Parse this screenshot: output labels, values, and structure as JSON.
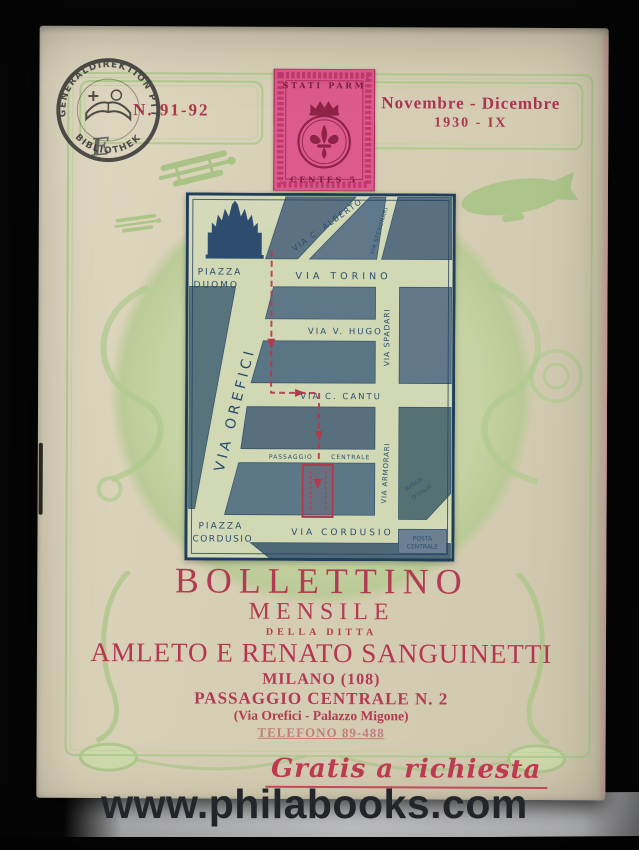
{
  "photo": {
    "watermark_text": "www.philabooks.com"
  },
  "cover": {
    "issue_number": "N. 91-92",
    "date_line1": "Novembre - Dicembre",
    "date_line2": "1930 - IX",
    "handwritten_mark": "E",
    "library_stamp": {
      "arc_top": "GENERALDIREKTION PTT",
      "arc_bottom": "BIBLIOTHEK"
    },
    "postage_stamp": {
      "top_label": "STATI PARM",
      "bottom_label": "CENTES 5"
    }
  },
  "map": {
    "streets": {
      "piazza_duomo_1": "PIAZZA",
      "piazza_duomo_2": "DUOMO",
      "via_c_alberto": "VIA C. ALBERTO",
      "via_speronari": "VIA SPERONARI",
      "via_torino": "VIA TORINO",
      "via_v_hugo": "VIA V. HUGO",
      "via_spadari": "VIA SPADARI",
      "via_c_cantu": "VIA C. CANTU",
      "via_orefici": "VIA OREFICI",
      "passaggio_1": "PASSAGGIO",
      "passaggio_2": "CENTRALE",
      "via_armorari": "VIA ARMORARI",
      "piazza_cordusio_1": "PIAZZA",
      "piazza_cordusio_2": "CORDUSIO",
      "via_cordusio": "VIA CORDUSIO",
      "banca_1": "BANCA",
      "banca_2": "D'ITALIA",
      "posta_1": "POSTA",
      "posta_2": "CENTRALE"
    }
  },
  "title_block": {
    "line1": "BOLLETTINO",
    "line2": "MENSILE",
    "line3": "DELLA DITTA",
    "company": "AMLETO E RENATO SANGUINETTI",
    "city": "MILANO (108)",
    "address": "PASSAGGIO CENTRALE N. 2",
    "address_detail": "(Via Orefici - Palazzo Migone)",
    "phone": "TELEFONO 89-488"
  },
  "footer": {
    "gratis": "Gratis a richiesta"
  },
  "colors": {
    "paper": "#d8d0b6",
    "green_accent": "#a9c685",
    "red_accent": "#b23a52",
    "stamp_pink": "#dc5b8c",
    "map_block": "#5e7487",
    "map_ink": "#2b4e70",
    "photo_background": "#070707"
  }
}
